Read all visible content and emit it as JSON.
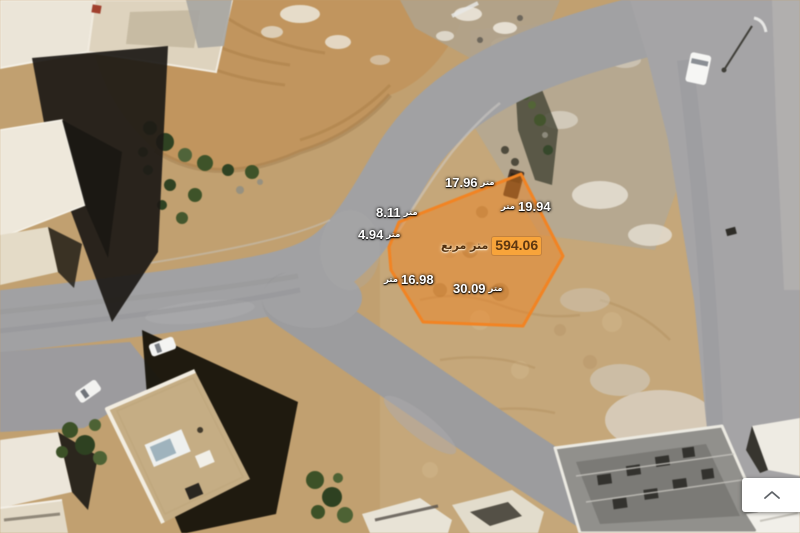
{
  "map": {
    "description": "satellite aerial imagery with highlighted land parcel",
    "parcel": {
      "area": {
        "value": "594.06",
        "unit": "متر مربع"
      },
      "edges": [
        {
          "value": "17.96",
          "unit": "متر"
        },
        {
          "value": "8.11",
          "unit": "متر"
        },
        {
          "value": "4.94",
          "unit": "متر"
        },
        {
          "value": "19.94",
          "unit": "متر"
        },
        {
          "value": "16.98",
          "unit": "متر"
        },
        {
          "value": "30.09",
          "unit": "متر"
        }
      ],
      "outline_color": "#f5831f",
      "fill_color": "rgba(243,132,30,0.48)",
      "area_badge_color": "#f8a43a"
    }
  },
  "controls": {
    "collapse_button": {
      "icon": "chevron-up"
    }
  }
}
